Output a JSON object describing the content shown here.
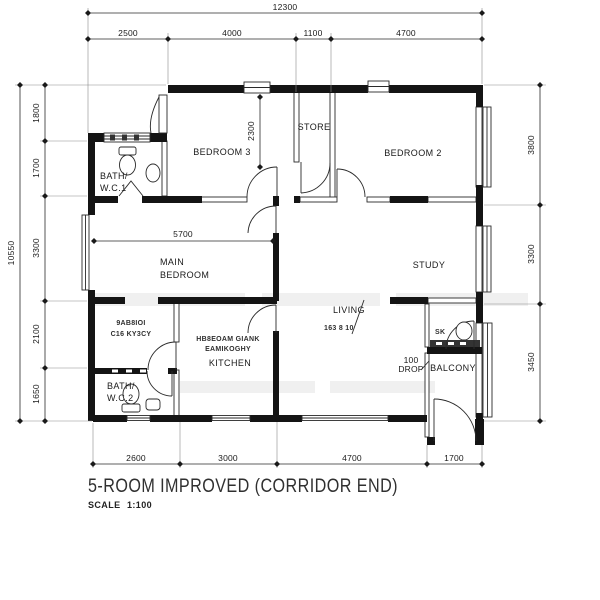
{
  "title": "5-ROOM IMPROVED (CORRIDOR END)",
  "scale": {
    "label": "SCALE",
    "value": "1:100"
  },
  "rooms": {
    "bedroom3": "BEDROOM 3",
    "store": "STORE",
    "bedroom2": "BEDROOM 2",
    "bath_wc1_line1": "BATH/",
    "bath_wc1_line2": "W.C.1",
    "main_bedroom_line1": "MAIN",
    "main_bedroom_line2": "BEDROOM",
    "study": "STUDY",
    "living_line1": "LIVING",
    "living_line2_garbled": "163 8 10",
    "kitchen": "KITCHEN",
    "bath_wc2_line1": "BATH/",
    "bath_wc2_line2": "W.C.2",
    "balcony": "BALCONY",
    "drop_line1": "100",
    "drop_line2": "DROP"
  },
  "watermarks": {
    "kitchen_line1": "HB8EOAM GIANK",
    "kitchen_line2": "EAMIKOGHY",
    "service_line1": "9AB8IOI",
    "service_line2": "C16 KY3CY",
    "balcony_small": "SK"
  },
  "dimensions": {
    "top_total": "12300",
    "top": [
      "2500",
      "4000",
      "1100",
      "4700"
    ],
    "left_total": "10550",
    "left": [
      "1800",
      "1700",
      "3300",
      "2100",
      "1650"
    ],
    "right": [
      "3800",
      "3300",
      "3450"
    ],
    "bottom": [
      "2600",
      "3000",
      "4700",
      "1700"
    ],
    "interior": {
      "hall_depth": "2300",
      "main_bedroom_width": "5700"
    }
  },
  "colors": {
    "ink": "#141414",
    "paper": "#ffffff",
    "faint_watermark": "#ebebeb"
  }
}
